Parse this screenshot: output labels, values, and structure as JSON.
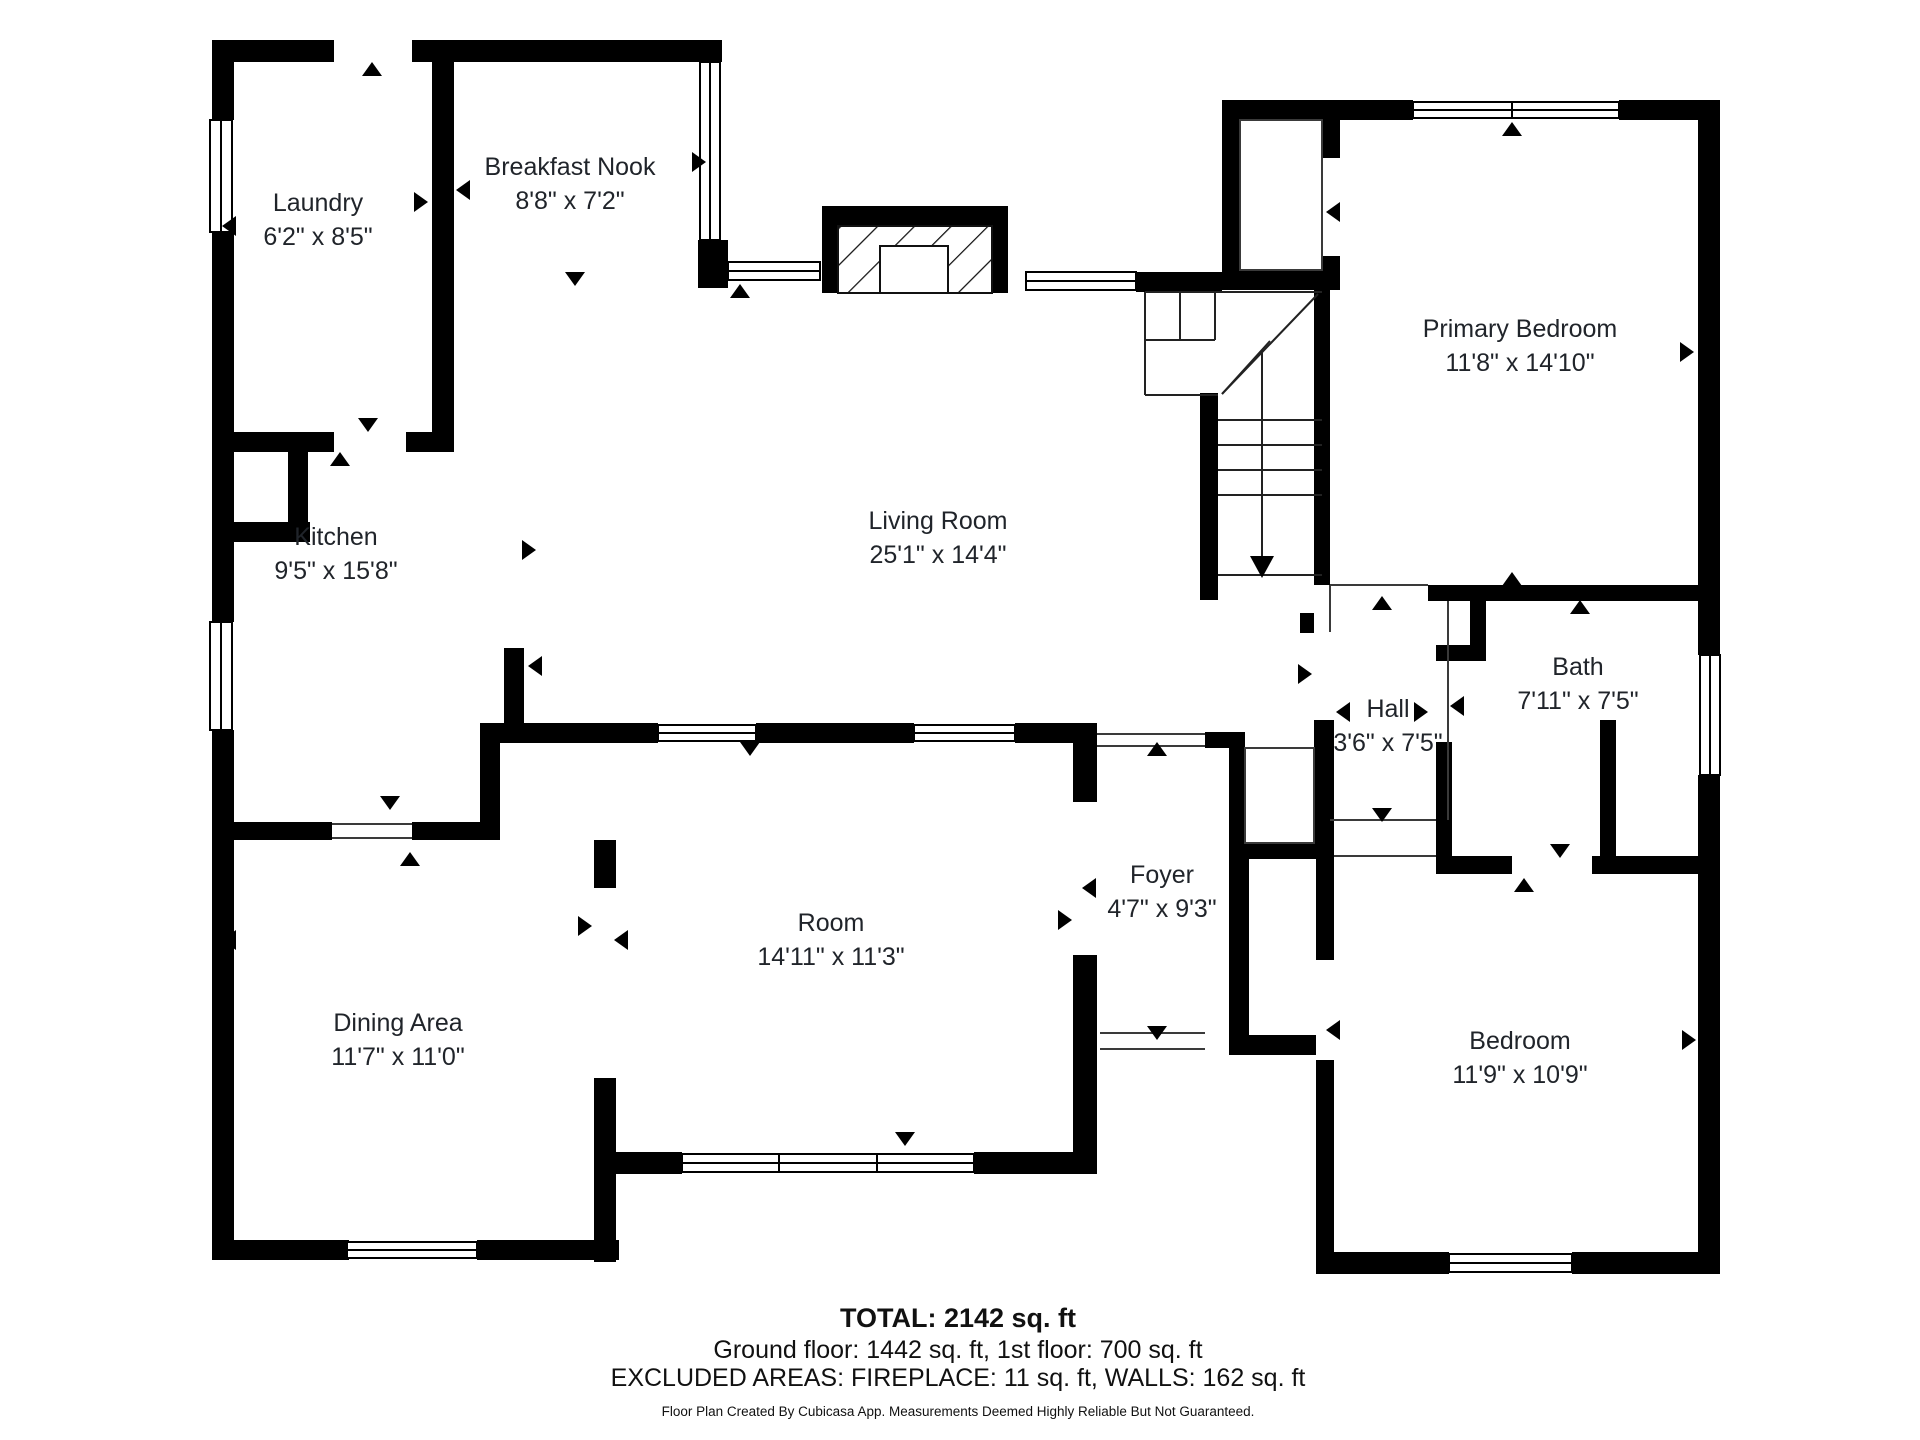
{
  "plan": {
    "rooms": {
      "laundry": {
        "name": "Laundry",
        "dims": "6'2\" x 8'5\""
      },
      "nook": {
        "name": "Breakfast Nook",
        "dims": "8'8\" x 7'2\""
      },
      "kitchen": {
        "name": "Kitchen",
        "dims": "9'5\" x 15'8\""
      },
      "living": {
        "name": "Living Room",
        "dims": "25'1\" x 14'4\""
      },
      "primary": {
        "name": "Primary Bedroom",
        "dims": "11'8\" x 14'10\""
      },
      "bath": {
        "name": "Bath",
        "dims": "7'11\" x 7'5\""
      },
      "hall": {
        "name": "Hall",
        "dims": "3'6\" x 7'5\""
      },
      "foyer": {
        "name": "Foyer",
        "dims": "4'7\" x 9'3\""
      },
      "room": {
        "name": "Room",
        "dims": "14'11\" x 11'3\""
      },
      "dining": {
        "name": "Dining Area",
        "dims": "11'7\" x 11'0\""
      },
      "bedroom": {
        "name": "Bedroom",
        "dims": "11'9\" x 10'9\""
      }
    },
    "footer": {
      "total": "TOTAL: 2142 sq. ft",
      "floors": "Ground floor: 1442 sq. ft, 1st floor: 700 sq. ft",
      "excluded": "EXCLUDED AREAS: FIREPLACE: 11 sq. ft, WALLS: 162 sq. ft",
      "disclaimer": "Floor Plan Created By Cubicasa App. Measurements Deemed Highly Reliable But Not Guaranteed."
    },
    "icons": {
      "door_swing": "black triangle marker",
      "window": "double-line glazing bar",
      "stairs_arrow": "down direction arrow"
    },
    "colors": {
      "wall": "#000000",
      "thin_line": "#3a3a3a",
      "text": "#20242a",
      "background": "#ffffff"
    }
  }
}
